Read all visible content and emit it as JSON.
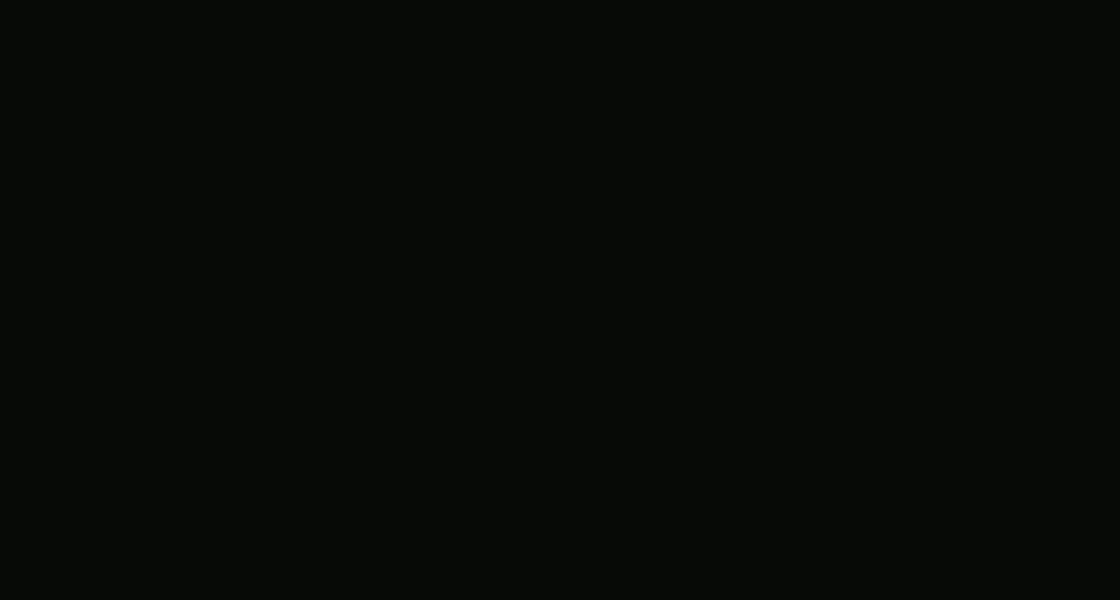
{
  "scene": {
    "name": "aerial-night-3d-render-of-gated-villa-complex",
    "bg": "#0a0d07",
    "complex_glow": "#fff3d0",
    "road_fill": "#514c49",
    "road_line": "#efece6",
    "lawn": "#2e4a17",
    "hedge": "#24330f",
    "pool_water": "#49c2ea",
    "deck": "#a3804e",
    "roof_dark": "#14161a",
    "roof_light": "#262931",
    "facade_warm": "#caa366",
    "window_glow": "#ffd894",
    "lamp_warm": "#ffe2a8"
  },
  "forest": {
    "regions": [
      {
        "x": 0,
        "y": 0,
        "w": 320,
        "h": 255,
        "n": 70,
        "seed": 11
      },
      {
        "x": 300,
        "y": 0,
        "w": 560,
        "h": 26,
        "n": 26,
        "seed": 21
      },
      {
        "x": 790,
        "y": 0,
        "w": 330,
        "h": 430,
        "n": 95,
        "seed": 31
      },
      {
        "x": 560,
        "y": 480,
        "w": 560,
        "h": 120,
        "n": 60,
        "seed": 41
      },
      {
        "x": 0,
        "y": 250,
        "w": 150,
        "h": 350,
        "n": 40,
        "seed": 51
      },
      {
        "x": 955,
        "y": 380,
        "w": 165,
        "h": 110,
        "n": 24,
        "seed": 61
      }
    ],
    "palette": [
      "#0d1509",
      "#111c0b",
      "#15240e",
      "#0a1207",
      "#182a10",
      "#1d3112"
    ],
    "accents": [
      [
        85,
        40,
        "#3d3012"
      ],
      [
        130,
        210,
        "#4a2c10"
      ],
      [
        40,
        130,
        "#33250e"
      ],
      [
        950,
        285,
        "#41280f"
      ],
      [
        1045,
        455,
        "#3a2a10"
      ],
      [
        880,
        120,
        "#33250e"
      ],
      [
        700,
        560,
        "#2e3b12"
      ],
      [
        240,
        40,
        "#3d3012"
      ],
      [
        1080,
        200,
        "#2a1d0a"
      ],
      [
        620,
        585,
        "#314012"
      ]
    ]
  },
  "greens": {
    "medians": [
      {
        "d": "M30,34 L88,2 L198,262 L438,578 L396,600 L240,600 Z",
        "fill": "#1c2a10"
      },
      {
        "d": "M-2,60 L150,598 L-2,598 Z",
        "fill": "#16230c"
      }
    ],
    "patches": [
      [
        64,
        100,
        16
      ],
      [
        100,
        200,
        18
      ],
      [
        150,
        330,
        20
      ],
      [
        205,
        435,
        22
      ],
      [
        258,
        525,
        24
      ],
      [
        305,
        578,
        22
      ],
      [
        28,
        280,
        14
      ],
      [
        58,
        400,
        16
      ],
      [
        32,
        560,
        30
      ],
      [
        95,
        548,
        20
      ]
    ]
  },
  "complex": {
    "lawn_d": "M330,66 L800,18 L905,118 L975,240 L1000,385 L750,443 L520,482 L470,525 L232,282 L262,206 L318,64 Z",
    "patches": [
      [
        400,
        162,
        50
      ],
      [
        545,
        160,
        48
      ],
      [
        690,
        165,
        45
      ],
      [
        390,
        250,
        55
      ],
      [
        550,
        255,
        55
      ],
      [
        760,
        250,
        50
      ],
      [
        470,
        320,
        60
      ],
      [
        580,
        400,
        70
      ],
      [
        900,
        380,
        65
      ],
      [
        860,
        250,
        50
      ],
      [
        630,
        90,
        40
      ],
      [
        470,
        110,
        40
      ],
      [
        940,
        330,
        40
      ],
      [
        330,
        300,
        35
      ],
      [
        650,
        440,
        45
      ],
      [
        740,
        420,
        40
      ],
      [
        360,
        120,
        38
      ],
      [
        850,
        140,
        30
      ]
    ]
  },
  "roads": {
    "polys": [
      {
        "name": "avenue-left",
        "d": "M-12,58 L32,46 L238,600 L152,600 Z",
        "fill": "#4e4a48"
      },
      {
        "name": "avenue-right-upper",
        "d": "M20,0 L82,0 L250,258 L182,268 Z",
        "fill": "#524d4b"
      },
      {
        "name": "boundary-road-lower",
        "d": "M182,268 L250,258 L500,552 L428,578 Z",
        "fill": "#575150"
      },
      {
        "name": "junction-south-patch",
        "d": "M400,543 L545,543 L568,600 L348,600 Z",
        "fill": "#5a5452"
      },
      {
        "name": "road-east",
        "d": "M446,554 Q470,512 520,484 L750,449 C880,429 1000,411 1120,393 L1120,488 C1000,506 880,527 760,549 Q640,574 500,597 Z",
        "fill": "#5d5754"
      },
      {
        "name": "road-top",
        "d": "M296,40 C420,30 600,16 816,4 L812,24 C640,30 430,48 308,62 Z",
        "fill": "#4a4644"
      },
      {
        "name": "boundary-road-left",
        "d": "M298,0 L334,0 C318,84 284,180 250,254 L196,258 C238,170 272,90 298,0 Z",
        "fill": "#4e4a48"
      }
    ],
    "lines": [
      "M-12,58 L152,600",
      "M32,46 L238,600",
      "M24,2 L190,264 L436,578",
      "M82,0 L250,258 L500,552",
      "M424,545 L364,600",
      "M446,554 Q470,512 520,484 L750,449 C880,429 1000,411 1120,393",
      "M500,597 Q640,574 760,549 C880,527 1000,506 1120,488",
      "M296,38 C420,28 600,14 816,2",
      "M308,62 C430,46 640,28 812,22",
      "M298,2 C282,84 256,170 198,256",
      "M334,2 C318,84 286,178 252,252"
    ],
    "sidewalk": {
      "d": "M504,604 Q642,580 762,556 C882,534 1002,512 1120,496",
      "color": "#6b645f"
    },
    "internal": {
      "d": "M612,84 C630,160 662,260 700,332 C716,370 730,408 748,445,",
      "w": 19,
      "fill": "#5a5248",
      "center": "#6a6156"
    },
    "islands": [
      {
        "d": "M183,249 L227,253 L188,305 Z",
        "fill": "#1e3010"
      },
      {
        "d": "M420,549 L530,577 L452,594 Z",
        "fill": "#2a4014"
      }
    ],
    "hatches": [
      [
        197,
        313,
        216,
        306
      ],
      [
        200,
        322,
        219,
        315
      ],
      [
        203,
        331,
        222,
        324
      ],
      [
        206,
        340,
        225,
        333
      ],
      [
        404,
        549,
        418,
        561
      ],
      [
        396,
        556,
        410,
        568
      ],
      [
        388,
        563,
        402,
        575
      ],
      [
        380,
        570,
        394,
        582
      ]
    ]
  },
  "lightpools": [
    [
      255,
      225,
      42
    ],
    [
      205,
      272,
      36
    ],
    [
      90,
      140,
      46
    ],
    [
      140,
      330,
      50
    ],
    [
      100,
      460,
      46
    ],
    [
      297,
      400,
      42
    ],
    [
      600,
      540,
      55
    ],
    [
      820,
      492,
      52
    ],
    [
      1000,
      448,
      46
    ],
    [
      470,
      565,
      46
    ],
    [
      640,
      200,
      30
    ],
    [
      700,
      330,
      30
    ],
    [
      340,
      45,
      36
    ],
    [
      520,
      28,
      36
    ],
    [
      700,
      14,
      36
    ],
    [
      612,
      92,
      26
    ],
    [
      170,
      520,
      40
    ],
    [
      60,
      80,
      36
    ],
    [
      910,
      468,
      44
    ]
  ],
  "pools": [
    {
      "x": 468,
      "y": 90,
      "w": 42,
      "h": 16,
      "rot": -6,
      "deck": 1,
      "swim": 0,
      "lounge": 0
    },
    {
      "x": 607,
      "y": 92,
      "w": 48,
      "h": 15,
      "rot": -4,
      "deck": 1,
      "swim": 0,
      "lounge": 0
    },
    {
      "x": 408,
      "y": 292,
      "w": 64,
      "h": 36,
      "rot": 3,
      "deck": 1,
      "swim": 0,
      "lounge": 1
    },
    {
      "x": 486,
      "y": 361,
      "w": 38,
      "h": 54,
      "rot": 6,
      "deck": 1,
      "swim": 1,
      "lounge": 1
    },
    {
      "x": 909,
      "y": 348,
      "w": 50,
      "h": 26,
      "rot": -18,
      "deck": 1,
      "swim": 1,
      "lounge": 1
    },
    {
      "x": 786,
      "y": 231,
      "w": 24,
      "h": 12,
      "rot": -14,
      "deck": 0,
      "swim": 0,
      "lounge": 0
    },
    {
      "x": 413,
      "y": 232,
      "w": 26,
      "h": 10,
      "rot": 12,
      "deck": 0,
      "swim": 0,
      "lounge": 0
    }
  ],
  "villas": [
    {
      "x": 438,
      "y": 50,
      "rot": -3,
      "w": 96,
      "h": 58,
      "dormers": 1
    },
    {
      "x": 601,
      "y": 44,
      "rot": -2,
      "w": 100,
      "h": 58,
      "dormers": 1
    },
    {
      "x": 397,
      "y": 120,
      "rot": 6,
      "w": 96,
      "h": 62,
      "dormers": 1
    },
    {
      "x": 540,
      "y": 112,
      "rot": 4,
      "w": 96,
      "h": 62,
      "dormers": 1
    },
    {
      "x": 684,
      "y": 122,
      "rot": 10,
      "w": 98,
      "h": 66,
      "dormers": 1
    },
    {
      "x": 384,
      "y": 208,
      "rot": 14,
      "w": 102,
      "h": 72,
      "dormers": 0
    },
    {
      "x": 546,
      "y": 213,
      "rot": 10,
      "w": 104,
      "h": 74,
      "dormers": 0
    },
    {
      "x": 757,
      "y": 204,
      "rot": 16,
      "w": 108,
      "h": 78,
      "dormers": 0
    },
    {
      "x": 572,
      "y": 333,
      "rot": 20,
      "w": 132,
      "h": 96,
      "dormers": 1
    },
    {
      "x": 856,
      "y": 306,
      "rot": 20,
      "w": 126,
      "h": 92,
      "dormers": 0
    }
  ],
  "roofboxes": [
    {
      "x": 366,
      "y": 88,
      "s": 20,
      "rot": -4
    },
    {
      "x": 391,
      "y": 155,
      "s": 17,
      "rot": 6
    },
    {
      "x": 663,
      "y": 77,
      "s": 18,
      "rot": -2
    },
    {
      "x": 524,
      "y": 160,
      "s": 16,
      "rot": 4
    },
    {
      "x": 607,
      "y": 229,
      "s": 18,
      "rot": 10
    },
    {
      "x": 546,
      "y": 288,
      "s": 18,
      "rot": 20
    },
    {
      "x": 808,
      "y": 245,
      "s": 26,
      "rot": 20
    }
  ],
  "carports": [
    {
      "x": 307,
      "y": 82,
      "w": 26,
      "h": 44,
      "rot": -14,
      "top": "#23251f"
    },
    {
      "x": 296,
      "y": 148,
      "w": 22,
      "h": 34,
      "rot": -14,
      "top": "#1d1f24"
    },
    {
      "x": 302,
      "y": 213,
      "w": 26,
      "h": 58,
      "rot": -16,
      "top": "#47301b"
    },
    {
      "x": 266,
      "y": 296,
      "w": 18,
      "h": 28,
      "rot": -34,
      "top": "#2a2c26"
    }
  ],
  "furniture": [
    [
      648,
      338
    ],
    [
      662,
      344
    ],
    [
      390,
      262
    ],
    [
      426,
      318
    ],
    [
      858,
      372
    ],
    [
      880,
      378
    ],
    [
      737,
      300
    ],
    [
      446,
      386
    ],
    [
      930,
      340
    ]
  ],
  "flowers": {
    "palette": {
      "o": "#d2701d",
      "m": "#c03d8c",
      "p": "#8a3fa8",
      "g": "#6f9c3f",
      "y": "#d8a62a"
    },
    "items": [
      [
        452,
        128,
        "m"
      ],
      [
        472,
        141,
        "o"
      ],
      [
        508,
        166,
        "g"
      ],
      [
        560,
        172,
        "m"
      ],
      [
        626,
        146,
        "p"
      ],
      [
        648,
        96,
        "m"
      ],
      [
        618,
        280,
        "o"
      ],
      [
        650,
        292,
        "m"
      ],
      [
        664,
        304,
        "p"
      ],
      [
        560,
        430,
        "m"
      ],
      [
        598,
        434,
        "o"
      ],
      [
        636,
        431,
        "m"
      ],
      [
        672,
        416,
        "p"
      ],
      [
        296,
        292,
        "o"
      ],
      [
        338,
        302,
        "g"
      ],
      [
        388,
        398,
        "o"
      ],
      [
        428,
        416,
        "o"
      ],
      [
        754,
        256,
        "m"
      ],
      [
        774,
        300,
        "p"
      ],
      [
        930,
        224,
        "g"
      ],
      [
        988,
        378,
        "o"
      ],
      [
        1002,
        390,
        "m"
      ],
      [
        548,
        240,
        "g"
      ],
      [
        508,
        330,
        "p"
      ],
      [
        438,
        346,
        "o"
      ],
      [
        906,
        56,
        "g"
      ],
      [
        836,
        58,
        "o"
      ],
      [
        690,
        360,
        "g"
      ],
      [
        525,
        95,
        "m"
      ],
      [
        606,
        60,
        "p"
      ],
      [
        354,
        360,
        "o"
      ],
      [
        576,
        470,
        "y"
      ]
    ]
  },
  "trees": [
    [
      332,
      262,
      15
    ],
    [
      448,
      252,
      13
    ],
    [
      940,
      300,
      16
    ],
    [
      1008,
      192,
      14
    ],
    [
      762,
      352,
      13
    ],
    [
      406,
      344,
      12
    ],
    [
      302,
      342,
      11
    ],
    [
      660,
      366,
      12
    ],
    [
      492,
      226,
      10
    ],
    [
      712,
      226,
      10
    ],
    [
      980,
      140,
      13
    ],
    [
      860,
      120,
      12
    ],
    [
      918,
      82,
      11
    ],
    [
      352,
      150,
      9
    ],
    [
      868,
      420,
      12
    ]
  ],
  "fence_dots": [
    [
      336,
      76
    ],
    [
      366,
      69
    ],
    [
      398,
      63
    ],
    [
      432,
      57
    ],
    [
      468,
      51
    ],
    [
      506,
      45
    ],
    [
      546,
      39
    ],
    [
      588,
      33
    ],
    [
      630,
      28
    ],
    [
      672,
      23
    ],
    [
      714,
      19
    ],
    [
      756,
      15
    ],
    [
      796,
      12
    ],
    [
      826,
      34
    ],
    [
      852,
      62
    ],
    [
      876,
      92
    ],
    [
      898,
      124
    ],
    [
      918,
      158
    ],
    [
      936,
      192
    ],
    [
      952,
      226
    ],
    [
      966,
      260
    ],
    [
      978,
      294
    ],
    [
      988,
      330
    ],
    [
      996,
      366
    ],
    [
      1000,
      385
    ],
    [
      948,
      404
    ],
    [
      864,
      424
    ],
    [
      780,
      442
    ],
    [
      700,
      458
    ],
    [
      620,
      476
    ],
    [
      545,
      496
    ],
    [
      495,
      512
    ],
    [
      456,
      540
    ],
    [
      412,
      500
    ],
    [
      372,
      452
    ],
    [
      334,
      404
    ],
    [
      298,
      356
    ],
    [
      264,
      310
    ],
    [
      240,
      282
    ],
    [
      250,
      240
    ],
    [
      268,
      212
    ],
    [
      282,
      166
    ],
    [
      292,
      120
    ],
    [
      300,
      80
    ]
  ],
  "gates": [
    {
      "x": 612,
      "y": 80,
      "rot": 4
    },
    {
      "x": 748,
      "y": 450,
      "rot": -14
    }
  ],
  "cars": [
    {
      "x": 258,
      "y": 217,
      "heading": 212,
      "len": 26,
      "wid": 12,
      "body": "#e9eaea",
      "glass": "#23262b",
      "beam": 0.55
    },
    {
      "x": 297,
      "y": 402,
      "heading": 207,
      "len": 26,
      "wid": 13,
      "body": "#c81f1f",
      "glass": "#1d1518",
      "beam": 0.3
    },
    {
      "x": 616,
      "y": 159,
      "heading": 190,
      "len": 21,
      "wid": 10,
      "body": "#c81f1f",
      "glass": "#1d1518",
      "beam": 0.25
    },
    {
      "x": 594,
      "y": 534,
      "heading": 258,
      "len": 28,
      "wid": 13,
      "body": "#eceded",
      "glass": "#141519",
      "beam": 0.5
    },
    {
      "x": 818,
      "y": 490,
      "heading": 280,
      "len": 27,
      "wid": 12,
      "body": "#b9bcbf",
      "glass": "#1b1d22",
      "beam": 0.45
    }
  ],
  "people": [
    {
      "x": 710,
      "y": 468,
      "c": "#d8d4c8"
    },
    {
      "x": 428,
      "y": 594,
      "c": "#c8a040"
    },
    {
      "x": 697,
      "y": 313,
      "c": "#cc2020"
    },
    {
      "x": 787,
      "y": 453,
      "c": "#d8b030"
    }
  ],
  "lamps": [
    [
      340,
      44
    ],
    [
      425,
      33
    ],
    [
      505,
      26
    ],
    [
      590,
      18
    ],
    [
      668,
      13
    ],
    [
      745,
      9
    ],
    [
      297,
      77
    ],
    [
      277,
      143
    ],
    [
      258,
      208
    ],
    [
      52,
      86
    ],
    [
      96,
      190
    ],
    [
      146,
      300
    ],
    [
      200,
      410
    ],
    [
      258,
      515
    ],
    [
      560,
      496
    ],
    [
      680,
      462
    ],
    [
      800,
      440
    ],
    [
      920,
      416
    ],
    [
      1040,
      396
    ],
    [
      640,
      196
    ],
    [
      668,
      262
    ],
    [
      698,
      330
    ],
    [
      726,
      392
    ],
    [
      612,
      118
    ]
  ],
  "mist": [
    [
      810,
      370,
      160,
      50
    ],
    [
      260,
      470,
      140,
      45
    ],
    [
      90,
      300,
      100,
      40
    ],
    [
      600,
      200,
      180,
      60
    ]
  ]
}
